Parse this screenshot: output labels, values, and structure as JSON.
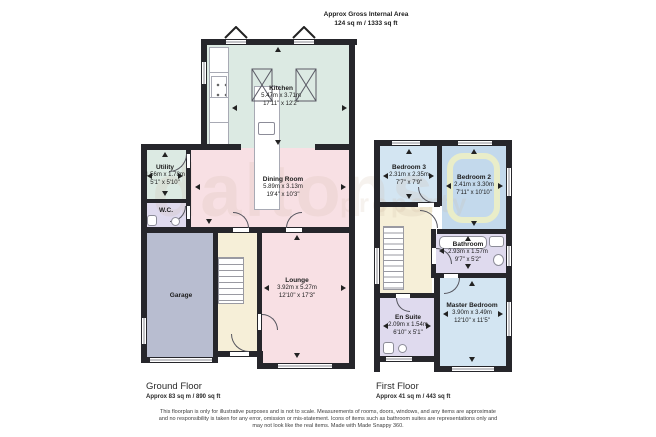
{
  "header": {
    "title": "Approx Gross Internal Area",
    "subtitle": "124 sq m / 1333 sq ft"
  },
  "watermark": {
    "part1": "daltons",
    "part2": "property"
  },
  "ground_floor": {
    "label": "Ground Floor",
    "area": "Approx 83 sq m / 890 sq ft",
    "rooms": [
      {
        "name": "Kitchen",
        "metric": "5.47m x 3.71m",
        "imperial": "17'11\" x 12'2\""
      },
      {
        "name": "Utility",
        "metric": "1.56m x 1.78m",
        "imperial": "5'1\" x 5'10\""
      },
      {
        "name": "W.C."
      },
      {
        "name": "Dining Room",
        "metric": "5.89m x 3.13m",
        "imperial": "19'4\" x 10'3\""
      },
      {
        "name": "Garage"
      },
      {
        "name": "Lounge",
        "metric": "3.92m x 5.27m",
        "imperial": "12'10\" x 17'3\""
      }
    ]
  },
  "first_floor": {
    "label": "First Floor",
    "area": "Approx 41 sq m / 443 sq ft",
    "rooms": [
      {
        "name": "Bedroom 3",
        "metric": "2.31m x 2.35m",
        "imperial": "7'7\" x 7'9\""
      },
      {
        "name": "Bedroom 2",
        "metric": "2.41m x 3.30m",
        "imperial": "7'11\" x 10'10\""
      },
      {
        "name": "Bathroom",
        "metric": "2.93m x 1.57m",
        "imperial": "9'7\" x 5'2\""
      },
      {
        "name": "En Suite",
        "metric": "2.09m x 1.54m",
        "imperial": "6'10\" x 5'1\""
      },
      {
        "name": "Master Bedroom",
        "metric": "3.90m x 3.49m",
        "imperial": "12'10\" x 11'5\""
      }
    ]
  },
  "disclaimer": [
    "This floorplan is only for illustrative purposes and is not to scale. Measurements of rooms, doors, windows, and any items are approximate",
    "and no responsibility is taken for any error, omission or mis-statement. Icons of items such as bathroom suites are representations only and",
    "may not look like the real items. Made with Made Snappy 360."
  ],
  "colors": {
    "wall": "#26262b",
    "kitchen_utility_green": "#dceae3",
    "living_pink": "#f8e0e4",
    "bathroom_lavender": "#dfdaee",
    "garage_grey": "#b8bdd0",
    "bedroom_blue": "#d3e5f2",
    "bedroom2_blue": "#c3d9ec",
    "highlight_ring": "#e9edc9",
    "hall_cream": "#f6efd8"
  }
}
